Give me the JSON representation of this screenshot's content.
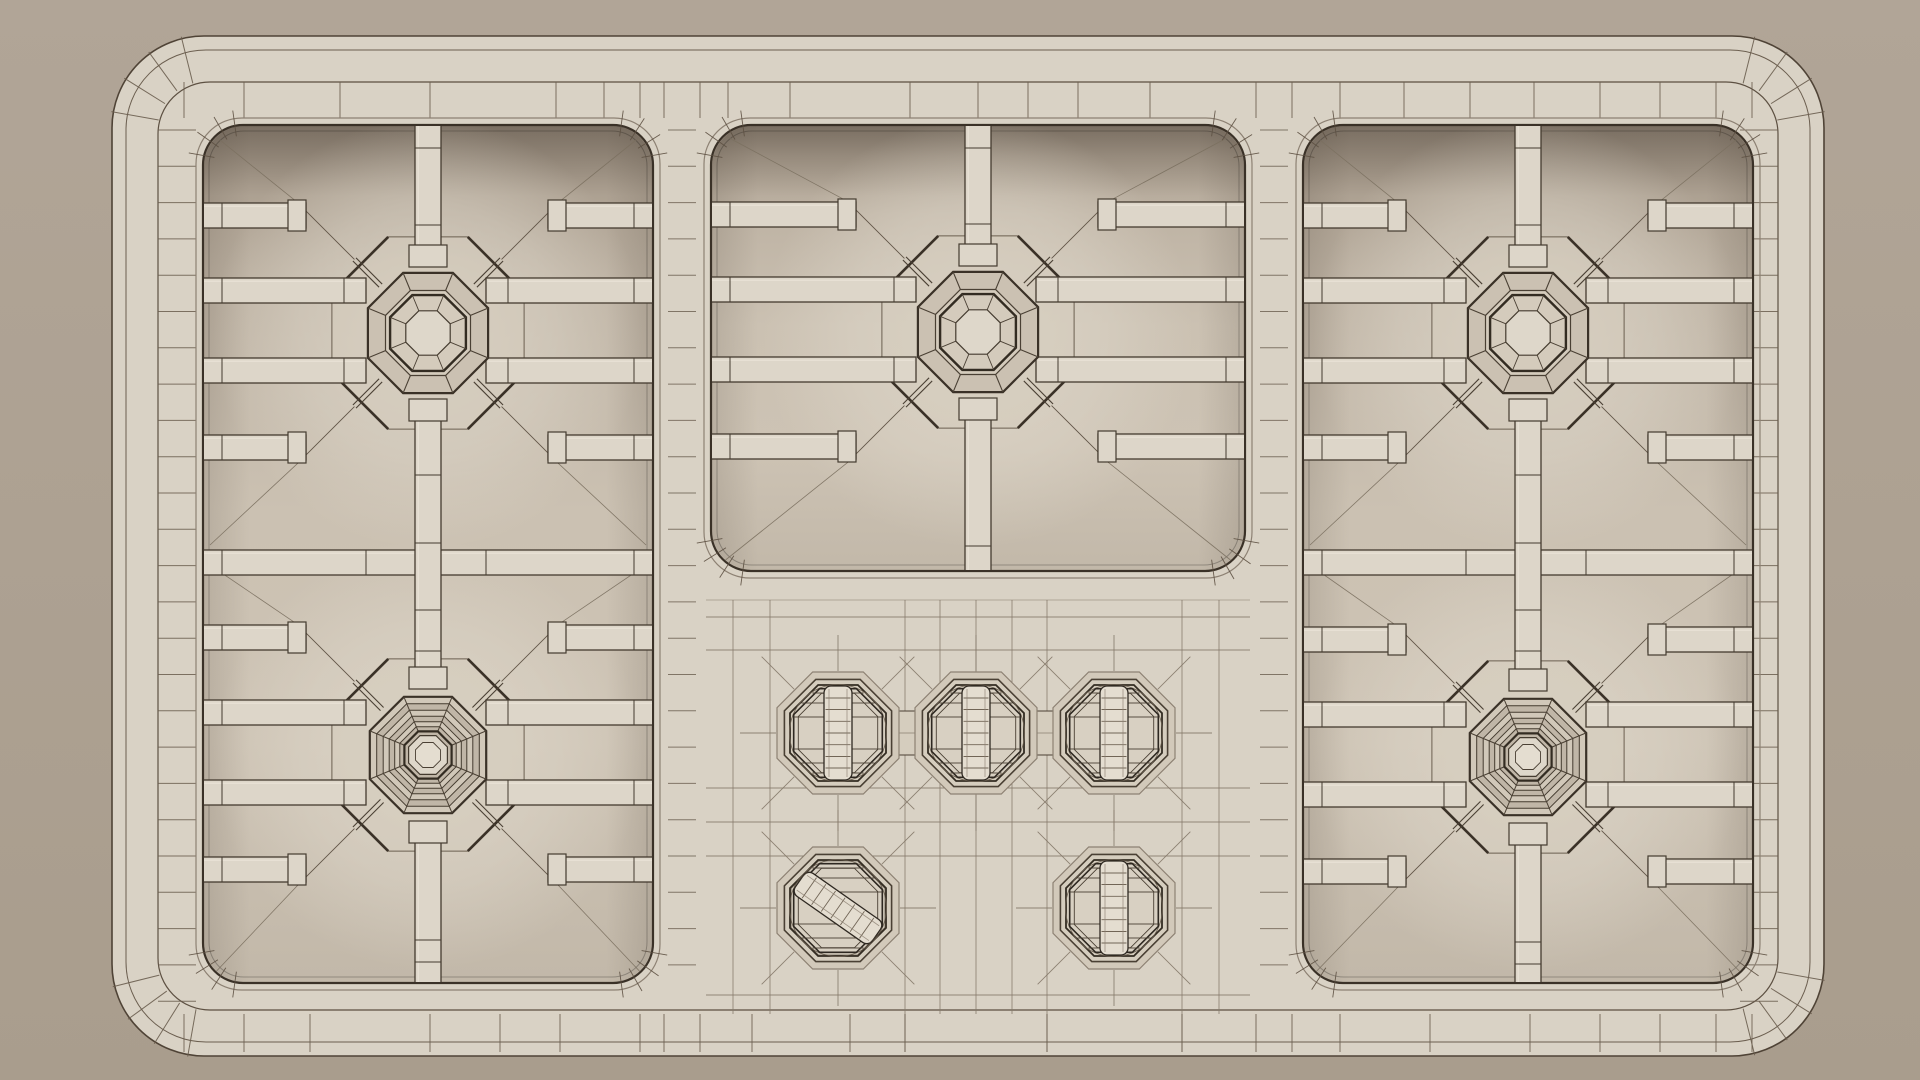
{
  "scene": {
    "description": "top-down-polygon-wireframe-render-of-5-burner-gas-cooktop",
    "object": "gas-cooktop",
    "view": "top-down",
    "style": "subdivision-wireframe",
    "canvas": {
      "width": 1920,
      "height": 1080
    },
    "colors": {
      "bg_top": "#b1a597",
      "bg_bottom": "#a99d8d",
      "body_fill": "#d9d2c5",
      "body_stroke": "#4f4336",
      "crease": "#6b5e4f",
      "crease2": "#5d5042",
      "panel_lip": "#8d8173",
      "panel_border": "#3a3127",
      "bar_fill": "#ddd6c9",
      "bar_stroke": "#443b2f",
      "bar_hi": "#ece6da",
      "ring_outer_fill": "#cbc1b2",
      "ring_mid_fill": "#d4cbbc",
      "ring_alt_fill": "#c0b6a7",
      "ring_alt2_fill": "#d1c8b9",
      "cap_fill": "#ded7ca",
      "groove": "#332c22",
      "line_thin": "#6b5f50",
      "line_med": "#4a4034",
      "line_faint": "#7b7060",
      "mesh": "#85796a",
      "knob_fill": "#d8d0c2",
      "knob_stroke": "#2e2821",
      "band_fill": "#e4ddd0",
      "pocket_fill": "#d2c9ba",
      "pocket_inner": "#d5cdbe",
      "frame_fill": "rgba(212,203,188,0.45)",
      "glow": "#ded7ca"
    },
    "body": {
      "x": 112,
      "y": 36,
      "w": 1712,
      "h": 1020,
      "r": 92,
      "crease_insets": [
        14,
        46
      ]
    },
    "rim": {
      "left_band": [
        158,
        196
      ],
      "right_band": [
        1740,
        1778
      ],
      "top_band": [
        82,
        118
      ],
      "bottom_band": [
        1014,
        1052
      ],
      "side_tick_start": 130,
      "side_tick_end": 1004,
      "side_tick_step": 36.3,
      "top_tick_xs": [
        184,
        244,
        340,
        430,
        556,
        604,
        640,
        664,
        700,
        728,
        790,
        910,
        978,
        1028,
        1078,
        1150,
        1256,
        1292,
        1340,
        1404,
        1470,
        1534,
        1600,
        1660,
        1716,
        1752
      ],
      "bottom_tick_xs": [
        184,
        244,
        310,
        430,
        500,
        560,
        640,
        664,
        700,
        752,
        850,
        905,
        1047,
        1182,
        1256,
        1292,
        1340,
        1430,
        1530,
        1600,
        1660,
        1716,
        1752
      ]
    },
    "dividers": [
      {
        "x0": 664,
        "x1": 700,
        "y0": 130,
        "y1": 978,
        "step": 36.3
      },
      {
        "x0": 1256,
        "x1": 1292,
        "y0": 130,
        "y1": 978,
        "step": 36.3
      }
    ],
    "panels": [
      {
        "id": "left",
        "x": 196,
        "y": 118,
        "w": 464,
        "h": 872,
        "r": 46,
        "mid_rail_y": 550
      },
      {
        "id": "center",
        "x": 704,
        "y": 118,
        "w": 548,
        "h": 460,
        "r": 46
      },
      {
        "id": "right",
        "x": 1296,
        "y": 118,
        "w": 464,
        "h": 872,
        "r": 46,
        "mid_rail_y": 550
      }
    ],
    "grate": {
      "bar_h": 25,
      "bar_w": 26,
      "finger_dy": [
        -130,
        102
      ],
      "pair_dy": [
        -55,
        25
      ],
      "finger_gap": 122,
      "pair_gap": 62,
      "tab_w": 38
    },
    "std_radii": {
      "ring_outer": 65,
      "ring_mid": 46,
      "groove": 41,
      "cap": 24,
      "frame": 104
    },
    "tall_radii": {
      "rings": [
        63,
        55.5,
        48.5,
        42,
        36,
        30.5
      ],
      "groove": 25.5,
      "cap": 21,
      "inner": 13.5,
      "frame": 104
    },
    "burners": [
      {
        "id": "rear-left",
        "panel": "left",
        "cx": 428,
        "cy": 333,
        "type": "standard",
        "vbar_top": [
          124,
          249,
          [
            148,
            225
          ]
        ],
        "vbar_bottom": [
          401,
          675,
          [
            475,
            543,
            610,
            651
          ]
        ],
        "diag_targets": [
          [
            210,
            132
          ],
          [
            646,
            132
          ],
          [
            646,
            545
          ],
          [
            210,
            545
          ]
        ]
      },
      {
        "id": "rear-center",
        "panel": "center",
        "cx": 978,
        "cy": 332,
        "type": "standard",
        "vbar_top": [
          124,
          248,
          [
            148,
            224
          ]
        ],
        "vbar_bottom": [
          400,
          572,
          [
            546
          ]
        ],
        "diag_targets": [
          [
            718,
            132
          ],
          [
            1238,
            132
          ],
          [
            1238,
            566
          ],
          [
            718,
            566
          ]
        ]
      },
      {
        "id": "rear-right",
        "panel": "right",
        "cx": 1528,
        "cy": 333,
        "type": "standard",
        "vbar_top": [
          124,
          249,
          [
            148,
            225
          ]
        ],
        "vbar_bottom": [
          401,
          675,
          [
            475,
            543,
            610,
            651
          ]
        ],
        "diag_targets": [
          [
            1310,
            132
          ],
          [
            1746,
            132
          ],
          [
            1746,
            545
          ],
          [
            1310,
            545
          ]
        ]
      },
      {
        "id": "front-left",
        "panel": "left",
        "cx": 428,
        "cy": 755,
        "type": "tall",
        "vbar_top": null,
        "vbar_bottom": [
          823,
          984,
          [
            940,
            962
          ]
        ],
        "diag_targets": [
          [
            210,
            565
          ],
          [
            646,
            565
          ],
          [
            646,
            978
          ],
          [
            210,
            978
          ]
        ]
      },
      {
        "id": "front-right",
        "panel": "right",
        "cx": 1528,
        "cy": 757,
        "type": "tall",
        "vbar_top": null,
        "vbar_bottom": [
          825,
          984,
          [
            942,
            964
          ]
        ],
        "diag_targets": [
          [
            1310,
            565
          ],
          [
            1746,
            565
          ],
          [
            1746,
            978
          ],
          [
            1310,
            978
          ]
        ]
      }
    ],
    "knob_panel": {
      "x": 704,
      "y": 600,
      "w": 548,
      "h": 414,
      "mesh_h": [
        617,
        650,
        788,
        822,
        856,
        995
      ],
      "mesh_v": [
        733,
        770,
        905,
        940,
        976,
        1012,
        1047,
        1182,
        1219
      ],
      "long_v": [
        905,
        1047,
        1182
      ],
      "bottom_line": 1014
    },
    "knob_radii": {
      "pocket_outer": 66,
      "pocket_mid": 58,
      "pocket_groove": 52,
      "sphere": 48,
      "inner_ring": 43,
      "band_halfw": 14
    },
    "knobs": [
      {
        "id": "rear-left",
        "cx": 838,
        "cy": 733,
        "rotation": 0
      },
      {
        "id": "rear-center",
        "cx": 976,
        "cy": 733,
        "rotation": 0
      },
      {
        "id": "rear-right",
        "cx": 1114,
        "cy": 733,
        "rotation": 0
      },
      {
        "id": "front-left",
        "cx": 838,
        "cy": 908,
        "rotation": -55
      },
      {
        "id": "front-right",
        "cx": 1114,
        "cy": 908,
        "rotation": 0
      }
    ],
    "knob_connectors": [
      {
        "x1": 838,
        "x2": 976,
        "y": 733
      },
      {
        "x1": 976,
        "x2": 1114,
        "y": 733
      }
    ]
  }
}
